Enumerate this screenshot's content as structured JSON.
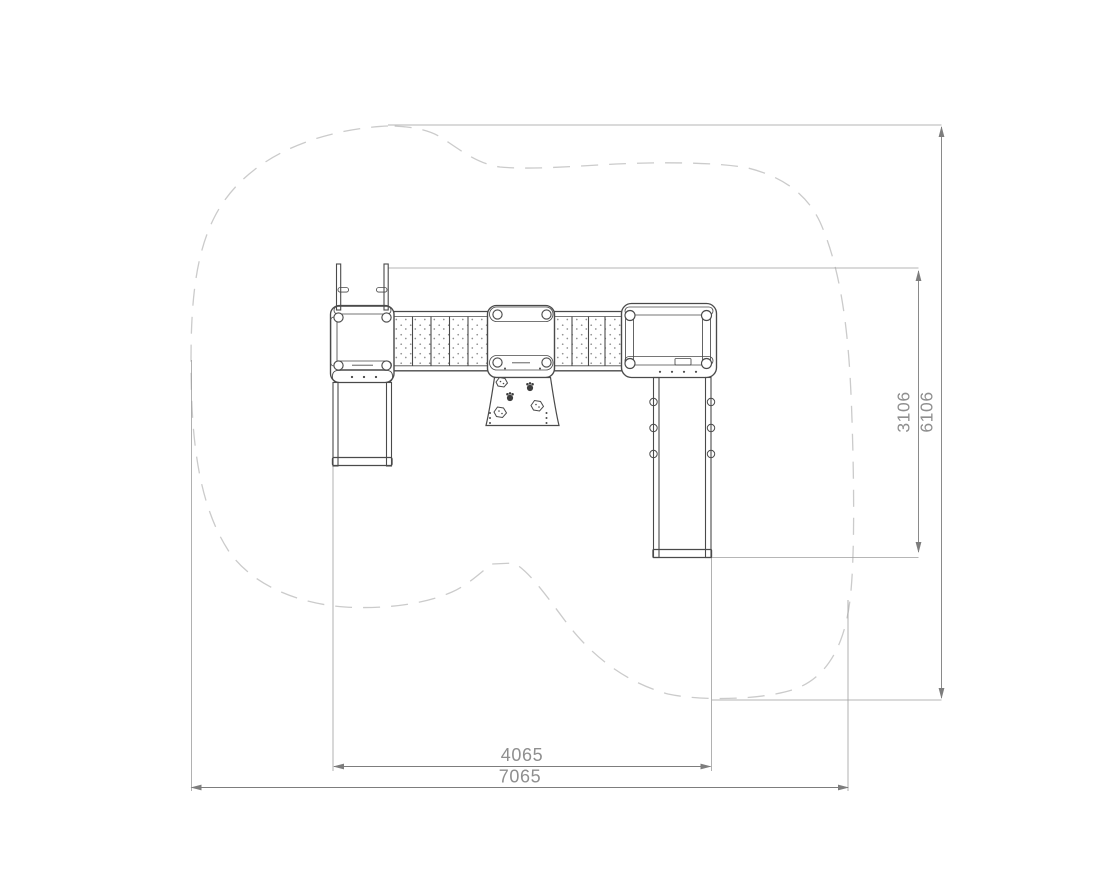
{
  "dimensions": {
    "bottom_inner": "4065",
    "bottom_outer": "7065",
    "right_inner": "3106",
    "right_outer": "6106"
  },
  "colors": {
    "background": "#ffffff",
    "structure_line": "#4a4a4a",
    "dimension_line": "#7d7d7d",
    "dimension_text": "#8f8f8f",
    "safety_zone_dash": "#cbcbcb",
    "extension_line": "#9e9e9e",
    "stipple_dot": "#909090"
  }
}
